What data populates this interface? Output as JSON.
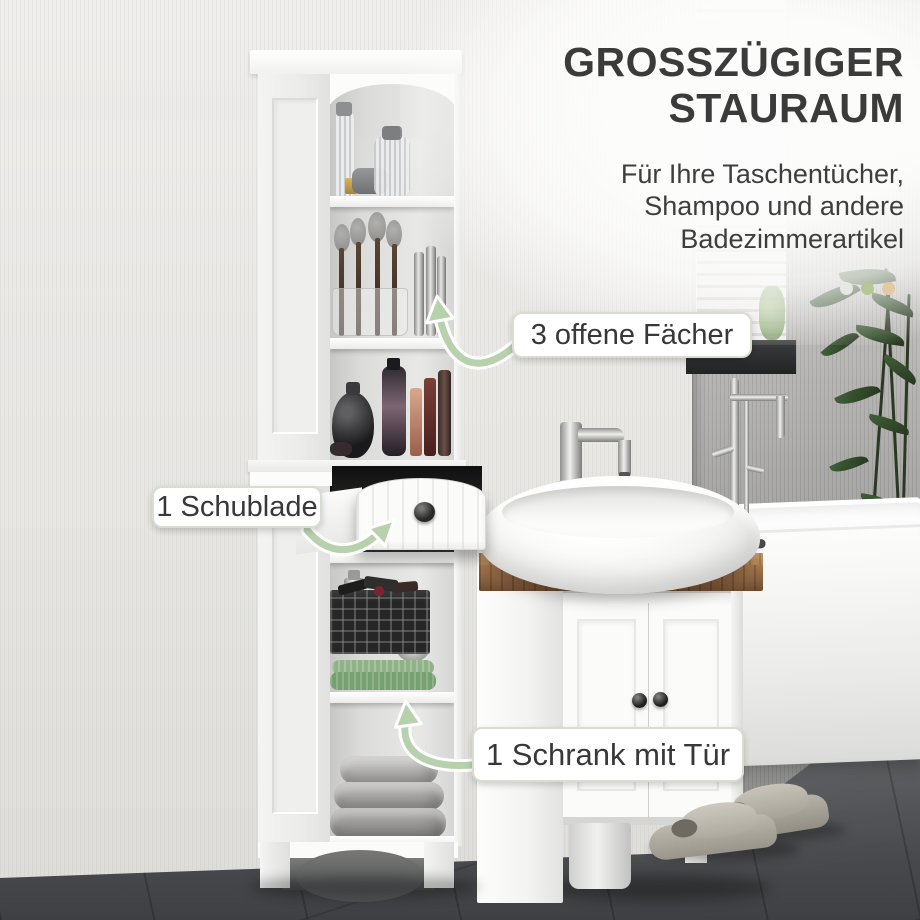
{
  "heading": {
    "line1": "GROSSZÜGIGER",
    "line2": "STAURAUM"
  },
  "subtitle": {
    "line1": "Für Ihre Taschentücher,",
    "line2": "Shampoo und andere",
    "line3": "Badezimmerartikel"
  },
  "callouts": {
    "shelves": "3 offene Fächer",
    "drawer": "1 Schublade",
    "cabinet": "1 Schrank mit Tür"
  },
  "dots": {
    "first": "#e6e8e4",
    "second": "#b5c795",
    "third": "#e2c9a3"
  },
  "colors": {
    "arrow_green": "#b7d1ad",
    "heading_text": "#3b3b3b",
    "label_text": "#383838",
    "label_border": "#d8ddd4",
    "wood_top": "#8a6242"
  }
}
